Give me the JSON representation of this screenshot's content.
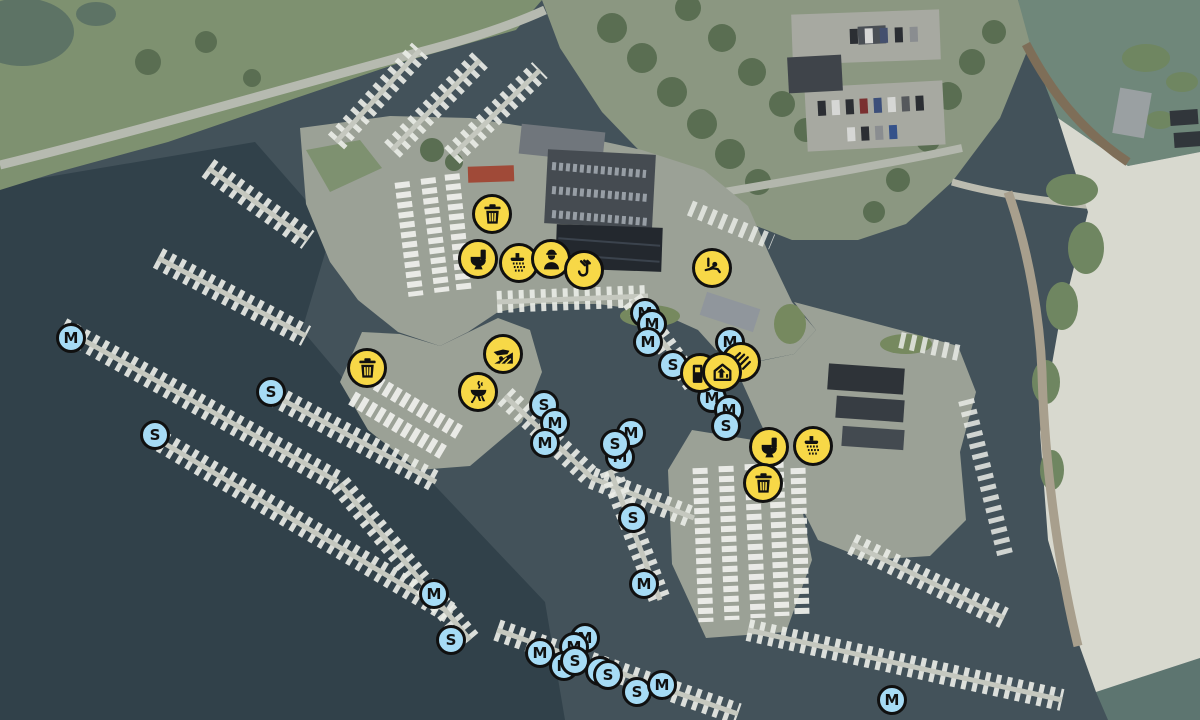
{
  "map": {
    "description": "aerial-marina-map",
    "colors": {
      "amenity_fill": "#f7d847",
      "berth_fill": "#a6dbf5",
      "ring": "#101010"
    },
    "markers": [
      {
        "label": "M",
        "x": 71,
        "y": 338
      },
      {
        "label": "S",
        "x": 271,
        "y": 392
      },
      {
        "label": "S",
        "x": 155,
        "y": 435
      },
      {
        "label": "M",
        "x": 645,
        "y": 313
      },
      {
        "label": "M",
        "x": 652,
        "y": 324
      },
      {
        "label": "M",
        "x": 648,
        "y": 342
      },
      {
        "label": "S",
        "x": 673,
        "y": 365
      },
      {
        "label": "M",
        "x": 730,
        "y": 342
      },
      {
        "label": "M",
        "x": 712,
        "y": 398
      },
      {
        "label": "M",
        "x": 729,
        "y": 410
      },
      {
        "label": "S",
        "x": 726,
        "y": 426
      },
      {
        "label": "S",
        "x": 544,
        "y": 405
      },
      {
        "label": "M",
        "x": 555,
        "y": 423
      },
      {
        "label": "M",
        "x": 545,
        "y": 443
      },
      {
        "label": "M",
        "x": 631,
        "y": 433
      },
      {
        "label": "M",
        "x": 620,
        "y": 457
      },
      {
        "label": "S",
        "x": 615,
        "y": 444
      },
      {
        "label": "S",
        "x": 633,
        "y": 518
      },
      {
        "label": "M",
        "x": 434,
        "y": 594
      },
      {
        "label": "S",
        "x": 451,
        "y": 640
      },
      {
        "label": "M",
        "x": 644,
        "y": 584
      },
      {
        "label": "M",
        "x": 540,
        "y": 653
      },
      {
        "label": "M",
        "x": 585,
        "y": 638
      },
      {
        "label": "M",
        "x": 574,
        "y": 647
      },
      {
        "label": "M",
        "x": 564,
        "y": 666
      },
      {
        "label": "S",
        "x": 575,
        "y": 661
      },
      {
        "label": "S",
        "x": 600,
        "y": 671
      },
      {
        "label": "S",
        "x": 608,
        "y": 675
      },
      {
        "label": "S",
        "x": 637,
        "y": 692
      },
      {
        "label": "M",
        "x": 662,
        "y": 685
      },
      {
        "label": "M",
        "x": 892,
        "y": 700
      },
      {
        "icon": "trash-icon",
        "x": 492,
        "y": 214
      },
      {
        "icon": "toilet-icon",
        "x": 478,
        "y": 259
      },
      {
        "icon": "shower-icon",
        "x": 519,
        "y": 263
      },
      {
        "icon": "staff-icon",
        "x": 551,
        "y": 259
      },
      {
        "icon": "crane-icon",
        "x": 584,
        "y": 270
      },
      {
        "icon": "playground-icon",
        "x": 712,
        "y": 268
      },
      {
        "icon": "trash-icon",
        "x": 367,
        "y": 368
      },
      {
        "icon": "slipway-icon",
        "x": 503,
        "y": 354
      },
      {
        "icon": "bbq-icon",
        "x": 478,
        "y": 392
      },
      {
        "icon": "service-icon",
        "x": 741,
        "y": 362
      },
      {
        "icon": "fuel-icon",
        "x": 700,
        "y": 373
      },
      {
        "icon": "boatyard-icon",
        "x": 722,
        "y": 372
      },
      {
        "icon": "toilet-icon",
        "x": 769,
        "y": 447
      },
      {
        "icon": "shower-icon",
        "x": 813,
        "y": 446
      },
      {
        "icon": "trash-icon",
        "x": 763,
        "y": 483
      }
    ]
  }
}
